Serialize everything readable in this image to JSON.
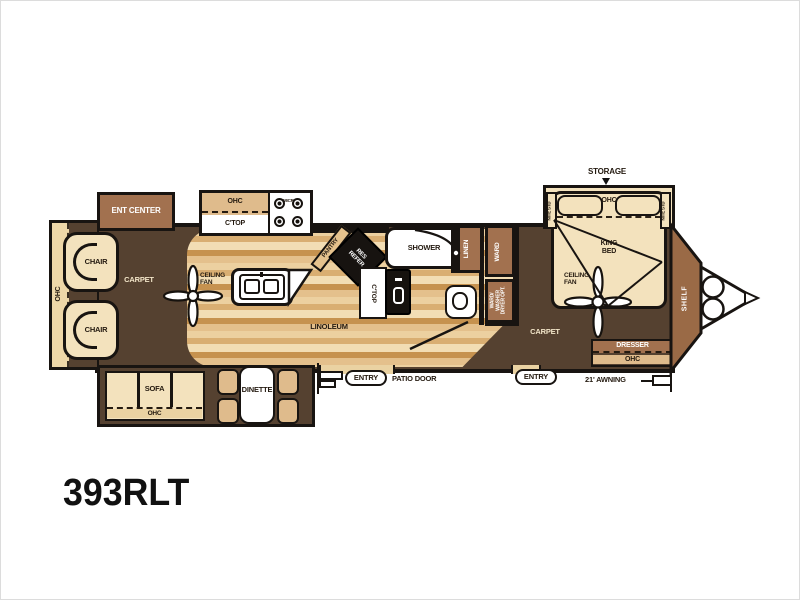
{
  "floorplan": {
    "model": "393RLT",
    "labels": {
      "storage": "STORAGE",
      "ent_center": "ENT CENTER",
      "ohc": "OHC",
      "ctop": "C'TOP",
      "micro": "MICRO",
      "chair": "CHAIR",
      "carpet": "CARPET",
      "ceiling": "CEILING",
      "fan": "FAN",
      "pantry": "PANTRY",
      "res": "RES",
      "refer": "REFER",
      "linoleum": "LINOLEUM",
      "shower": "SHOWER",
      "linen": "LINEN",
      "ward": "WARD",
      "ward_washer_1": "WARD/",
      "ward_washer_2": "WASHER",
      "ward_washer_3": "DRYER OPT.",
      "king": "KING",
      "bed": "BED",
      "nite_std": "NITE STD",
      "dresser": "DRESSER",
      "shelf": "SHELF",
      "sofa": "SOFA",
      "dinette": "DINETTE",
      "entry": "ENTRY",
      "patio_door": "PATIO DOOR",
      "awning": "21' AWNING"
    },
    "colors": {
      "carpet": "#554130",
      "wood_light": "#f0d9ae",
      "wood_mid": "#dfb586",
      "wood_dark": "#c3914f",
      "cabinet_brown": "#a2714f",
      "cabinet_tan": "#dfbb8c",
      "upholstery_cream": "#f3e2bd",
      "wall_black": "#181411",
      "cap_brown": "#9a6a46",
      "fixture_white": "#ffffff"
    }
  }
}
